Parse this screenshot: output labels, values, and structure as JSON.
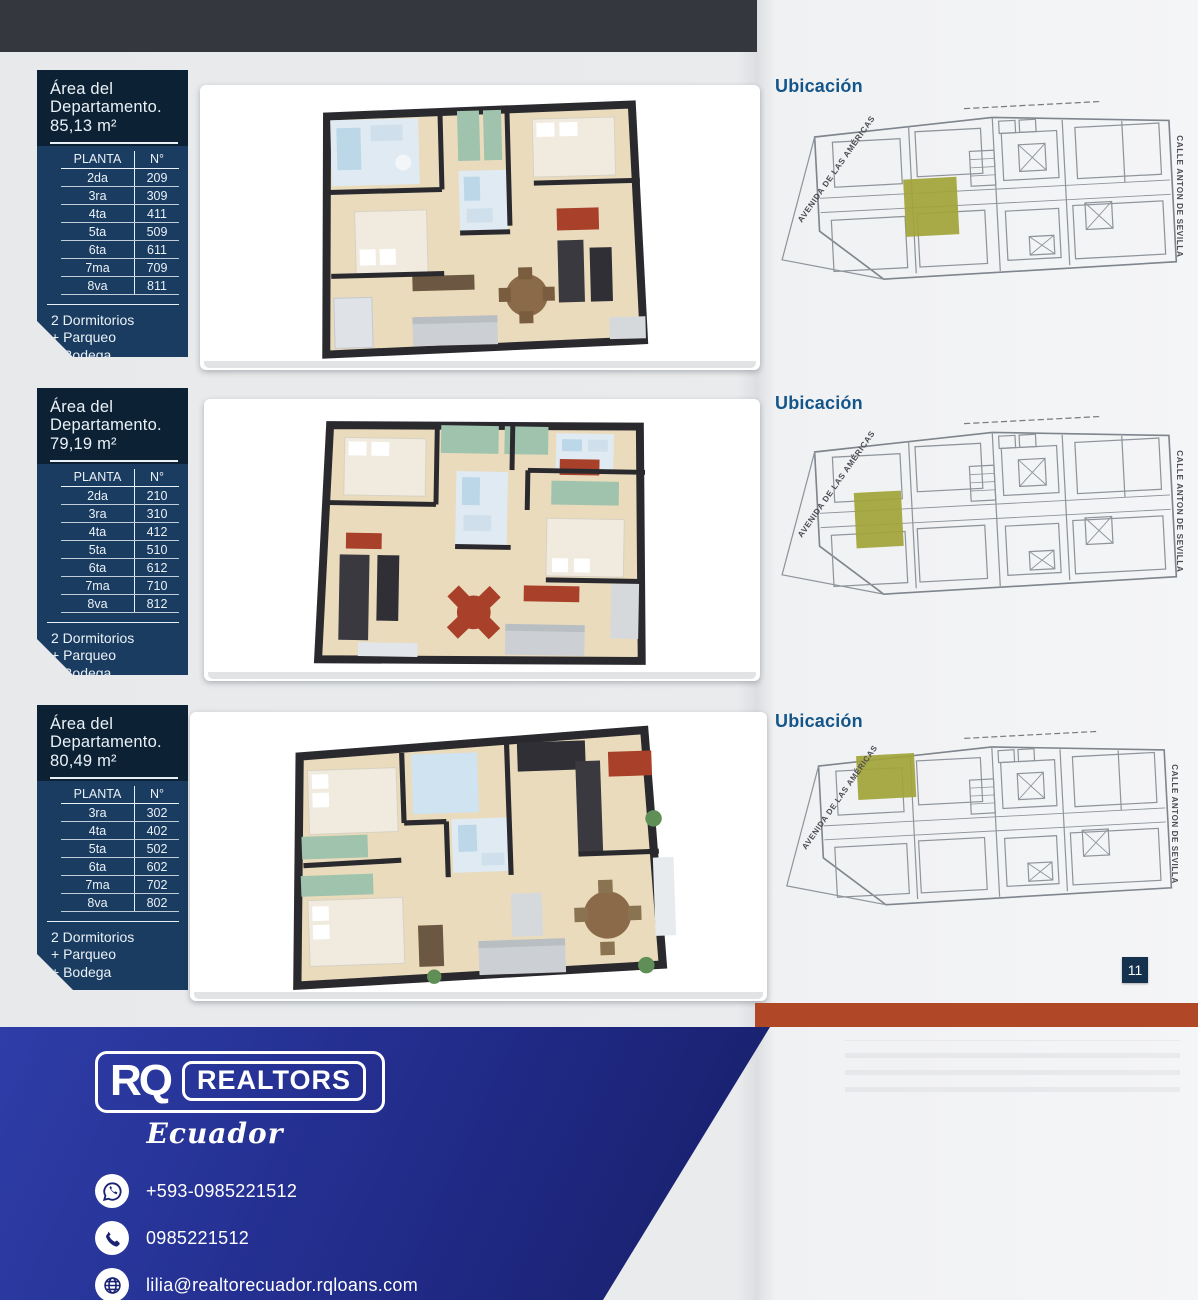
{
  "page": {
    "number": "11"
  },
  "sections": [
    {
      "title_line1": "Área del",
      "title_line2": "Departamento.",
      "area": "85,13 m²",
      "ubicacion_label": "Ubicación",
      "table": {
        "col_planta": "PLANTA",
        "col_n": "N°",
        "rows": [
          {
            "floor": "2da",
            "unit": "209"
          },
          {
            "floor": "3ra",
            "unit": "309"
          },
          {
            "floor": "4ta",
            "unit": "411"
          },
          {
            "floor": "5ta",
            "unit": "509"
          },
          {
            "floor": "6ta",
            "unit": "611"
          },
          {
            "floor": "7ma",
            "unit": "709"
          },
          {
            "floor": "8va",
            "unit": "811"
          }
        ]
      },
      "features": [
        "2 Dormitorios",
        "+ Parqueo",
        "+ Bodega"
      ]
    },
    {
      "title_line1": "Área del",
      "title_line2": "Departamento.",
      "area": "79,19 m²",
      "ubicacion_label": "Ubicación",
      "table": {
        "col_planta": "PLANTA",
        "col_n": "N°",
        "rows": [
          {
            "floor": "2da",
            "unit": "210"
          },
          {
            "floor": "3ra",
            "unit": "310"
          },
          {
            "floor": "4ta",
            "unit": "412"
          },
          {
            "floor": "5ta",
            "unit": "510"
          },
          {
            "floor": "6ta",
            "unit": "612"
          },
          {
            "floor": "7ma",
            "unit": "710"
          },
          {
            "floor": "8va",
            "unit": "812"
          }
        ]
      },
      "features": [
        "2 Dormitorios",
        "+ Parqueo",
        "+ Bodega"
      ]
    },
    {
      "title_line1": "Área del",
      "title_line2": "Departamento.",
      "area": "80,49 m²",
      "ubicacion_label": "Ubicación",
      "table": {
        "col_planta": "PLANTA",
        "col_n": "N°",
        "rows": [
          {
            "floor": "3ra",
            "unit": "302"
          },
          {
            "floor": "4ta",
            "unit": "402"
          },
          {
            "floor": "5ta",
            "unit": "502"
          },
          {
            "floor": "6ta",
            "unit": "602"
          },
          {
            "floor": "7ma",
            "unit": "702"
          },
          {
            "floor": "8va",
            "unit": "802"
          }
        ]
      },
      "features": [
        "2 Dormitorios",
        "+ Parqueo",
        "+ Bodega"
      ]
    }
  ],
  "map": {
    "street_left": "AVENIDA DE LAS AMÉRICAS",
    "street_right": "CALLE ANTON DE SEVILLA"
  },
  "footer": {
    "logo_rq": "RQ",
    "logo_realtors": "REALTORS",
    "logo_country": "Ecuador",
    "contacts": [
      {
        "icon": "whatsapp-icon",
        "label": "+593-0985221512"
      },
      {
        "icon": "phone-icon",
        "label": "0985221512"
      },
      {
        "icon": "globe-icon",
        "label": "lilia@realtorecuador.rqloans.com"
      }
    ]
  },
  "colors": {
    "topbar": "#35373f",
    "navy_header": "#0d2134",
    "navy_body": "#1a3c60",
    "orange": "#b04727",
    "olive": "#a2a437",
    "ubicacion_blue": "#15568a",
    "footer_blue": "#1b2478"
  }
}
